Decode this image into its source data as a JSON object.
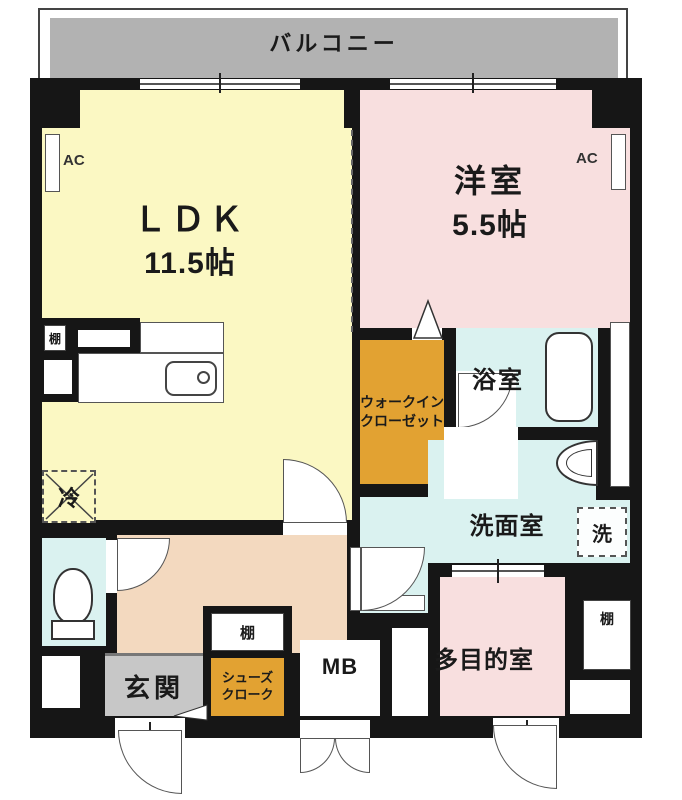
{
  "balcony": {
    "label": "バルコニー"
  },
  "rooms": {
    "ldk": {
      "name": "ＬＤＫ",
      "size": "11.5帖"
    },
    "western": {
      "name": "洋室",
      "size": "5.5帖"
    },
    "bathroom": {
      "name": "浴室"
    },
    "washroom": {
      "name": "洗面室"
    },
    "multipurpose": {
      "name": "多目的室"
    },
    "entrance": {
      "name": "玄関"
    },
    "walk_in_closet": {
      "line1": "ウォークイン",
      "line2": "クローゼット"
    },
    "shoe_closet": {
      "line1": "シューズ",
      "line2": "クローク"
    },
    "meter_box": {
      "label": "MB"
    }
  },
  "fixtures": {
    "ac": "AC",
    "shelf": "棚",
    "refrigerator": "冷",
    "washer": "洗"
  },
  "colors": {
    "ldk_yellow": "#FBF8C3",
    "bedroom_pink": "#F8DFDF",
    "wet_area_blue": "#DAF2F0",
    "closet_orange": "#E2A232",
    "hall_beige": "#F3D9BF",
    "entrance_gray": "#C7C7C7",
    "balcony_gray": "#B2B2B2",
    "wall_black": "#161616"
  }
}
